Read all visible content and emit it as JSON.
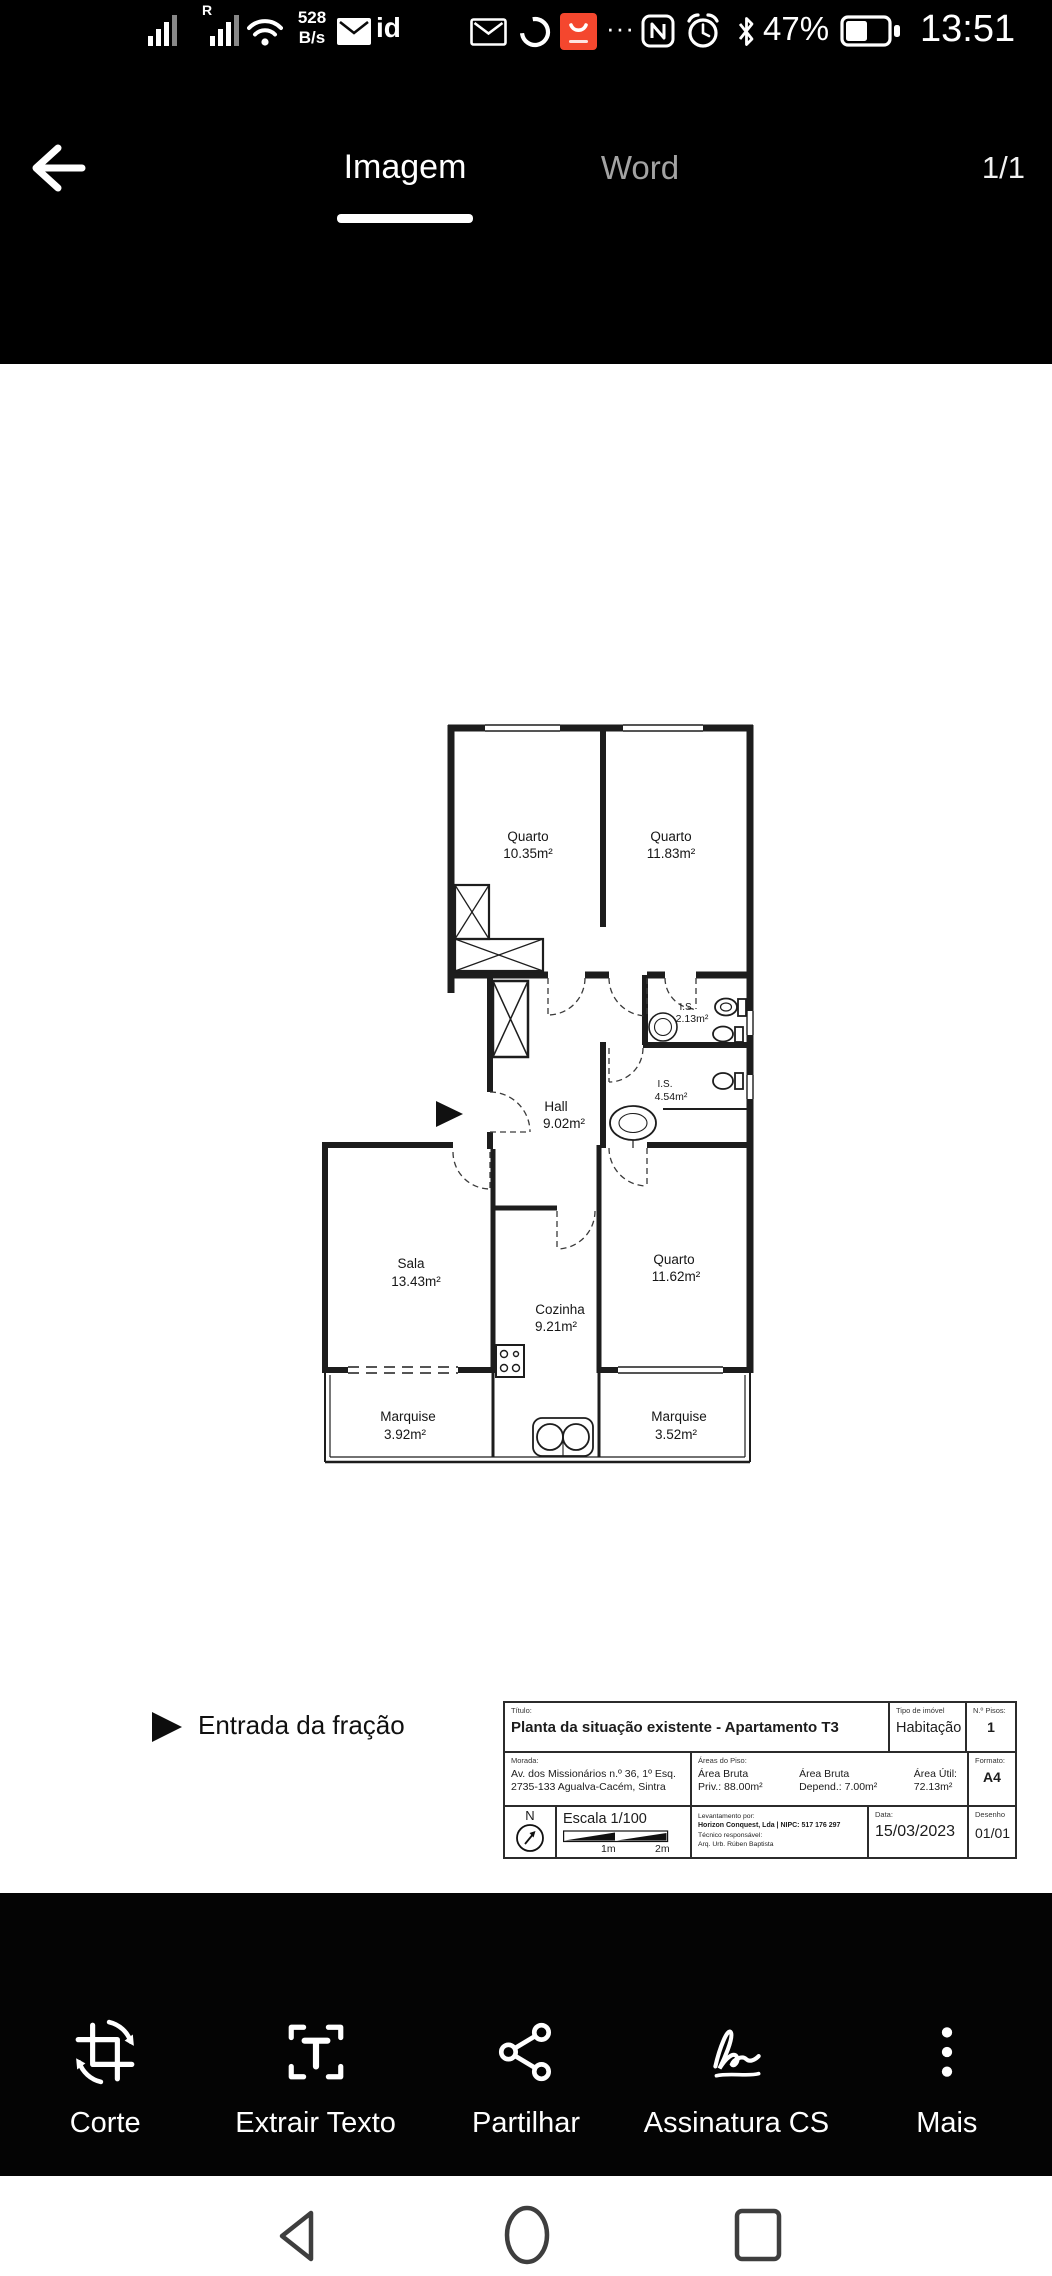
{
  "status_bar": {
    "net_speed_value": "528",
    "net_speed_unit": "B/s",
    "sim_roaming_badge": "R",
    "id_badge": "id",
    "overflow_dots": "···",
    "battery_percent": "47%",
    "time": "13:51"
  },
  "header": {
    "tab_imagem": "Imagem",
    "tab_word": "Word",
    "page_indicator": "1/1"
  },
  "document": {
    "entrance_note": "Entrada da fração",
    "rooms": {
      "quarto1": {
        "name": "Quarto",
        "area": "10.35m²"
      },
      "quarto2": {
        "name": "Quarto",
        "area": "11.83m²"
      },
      "is1": {
        "name": "I.S.",
        "area": "2.13m²"
      },
      "is2": {
        "name": "I.S.",
        "area": "4.54m²"
      },
      "hall": {
        "name": "Hall",
        "area": "9.02m²"
      },
      "sala": {
        "name": "Sala",
        "area": "13.43m²"
      },
      "cozinha": {
        "name": "Cozinha",
        "area": "9.21m²"
      },
      "quarto3": {
        "name": "Quarto",
        "area": "11.62m²"
      },
      "marquise1": {
        "name": "Marquise",
        "area": "3.92m²"
      },
      "marquise2": {
        "name": "Marquise",
        "area": "3.52m²"
      }
    },
    "title_block": {
      "titulo_label": "Título:",
      "titulo": "Planta da situação existente - Apartamento T3",
      "tipo_imovel_label": "Tipo de imóvel",
      "tipo_imovel": "Habitação",
      "pisos_label": "N.º Pisos:",
      "pisos": "1",
      "morada_label": "Morada:",
      "morada_linha1": "Av. dos Missionários n.º 36, 1º Esq.",
      "morada_linha2": "2735-133 Agualva-Cacém, Sintra",
      "areas_label": "Áreas do Piso:",
      "area_bruta_priv_l1": "Área Bruta",
      "area_bruta_priv_l2": "Priv.: 88.00m²",
      "area_bruta_dep_l1": "Área Bruta",
      "area_bruta_dep_l2": "Depend.: 7.00m²",
      "area_util_l1": "Área Útil:",
      "area_util_l2": "72.13m²",
      "formato_label": "Formato:",
      "formato": "A4",
      "north": "N",
      "escala": "Escala 1/100",
      "escala_1m": "1m",
      "escala_2m": "2m",
      "levantamento_label": "Levantamento por:",
      "levantamento": "Horizon Conquest, Lda | NIPC: 517 176 297",
      "tecnico_label": "Técnico responsável:",
      "tecnico": "Arq. Urb. Rúben Baptista",
      "data_label": "Data:",
      "data": "15/03/2023",
      "desenho_label": "Desenho",
      "desenho": "01/01"
    }
  },
  "toolbar": {
    "items": [
      {
        "label": "Corte"
      },
      {
        "label": "Extrair Texto"
      },
      {
        "label": "Partilhar"
      },
      {
        "label": "Assinatura CS"
      },
      {
        "label": "Mais"
      }
    ]
  }
}
